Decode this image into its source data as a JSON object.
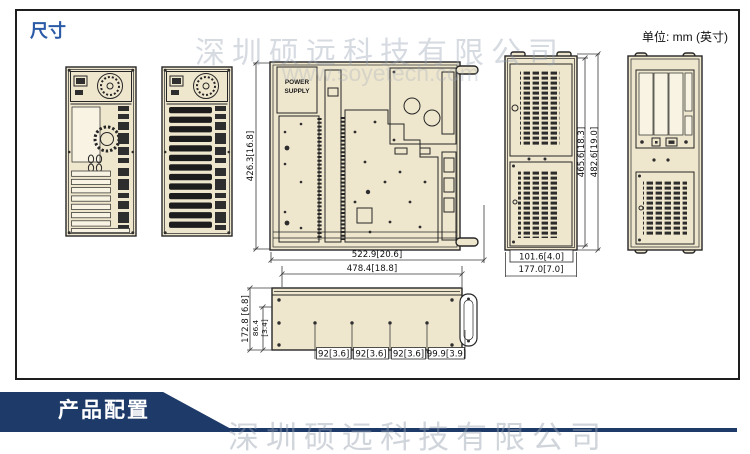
{
  "page": {
    "title": "尺寸",
    "unit_label": "单位: mm (英寸)",
    "banner_label": "产品配置",
    "watermark_company": "深圳硕远科技有限公司",
    "watermark_url": "www.soyetech.com"
  },
  "colors": {
    "accent_blue": "#2b5aa7",
    "banner_navy": "#1d3a68",
    "drawing_fill": "#eee6cd",
    "line": "#262626"
  },
  "dimensions": {
    "top_view": {
      "power_supply_line1": "POWER",
      "power_supply_line2": "SUPPLY",
      "height": "426.3[16.8]",
      "width_outer": "522.9[20.6]",
      "width_inner": "478.4[18.8]"
    },
    "side_view": {
      "height_inner": "465.6[18.3]",
      "height_outer": "482.6[19.0]",
      "depth_inner": "101.6[4.0]",
      "depth_outer": "177.0[7.0]"
    },
    "profile_view": {
      "height_total": "172.8 [6.8]",
      "height_inner_mm": "86.4",
      "height_inner_in": "[3.4]",
      "spacings": [
        "92[3.6]",
        "92[3.6]",
        "92[3.6]",
        "99.9[3.9]"
      ]
    }
  }
}
